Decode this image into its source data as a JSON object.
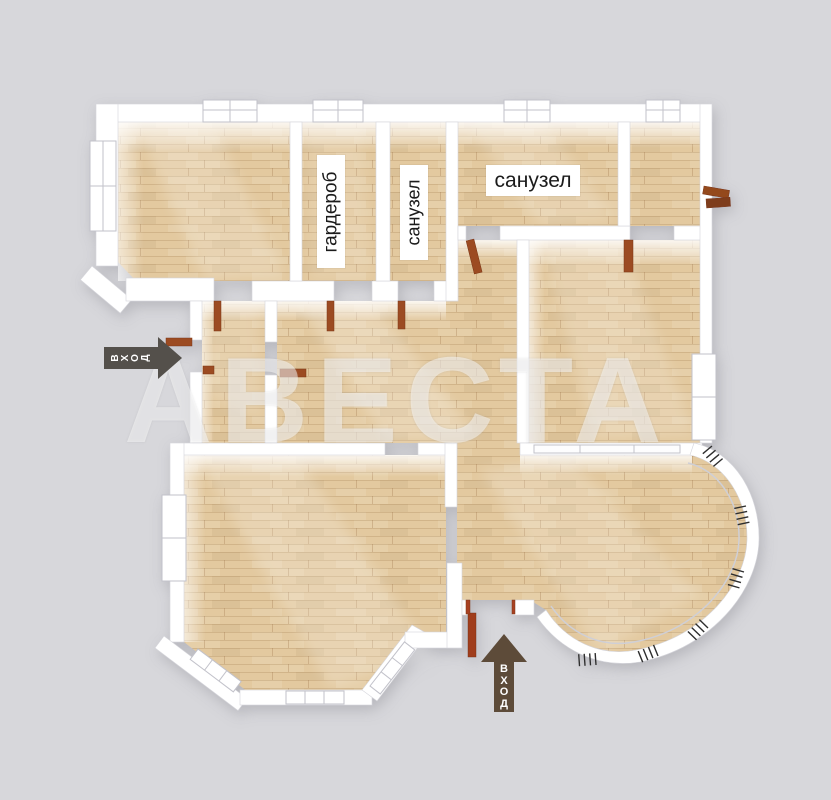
{
  "floor_plan": {
    "watermark_text": "АВЕСТА",
    "room_labels": [
      {
        "id": "wardrobe",
        "text": "гардероб",
        "orientation": "vertical"
      },
      {
        "id": "bathroom-small",
        "text": "санузел",
        "orientation": "vertical"
      },
      {
        "id": "bathroom-large",
        "text": "санузел",
        "orientation": "horizontal"
      }
    ],
    "entrance_labels": {
      "side": "ВХОД",
      "main": "ВХОД"
    },
    "icons": {
      "side_entrance": "entrance-arrow-right-icon",
      "main_entrance": "entrance-arrow-up-icon"
    },
    "colors": {
      "background": "#d7d7db",
      "walls": "#ffffff",
      "floor_wood": "#e3c99f",
      "door": "#9c4c24",
      "label_background": "#ffffff",
      "label_text": "#1b1b1b",
      "side_arrow": "#54504b",
      "main_arrow": "#5d4b39",
      "watermark": "rgba(255,255,255,0.48)"
    }
  }
}
